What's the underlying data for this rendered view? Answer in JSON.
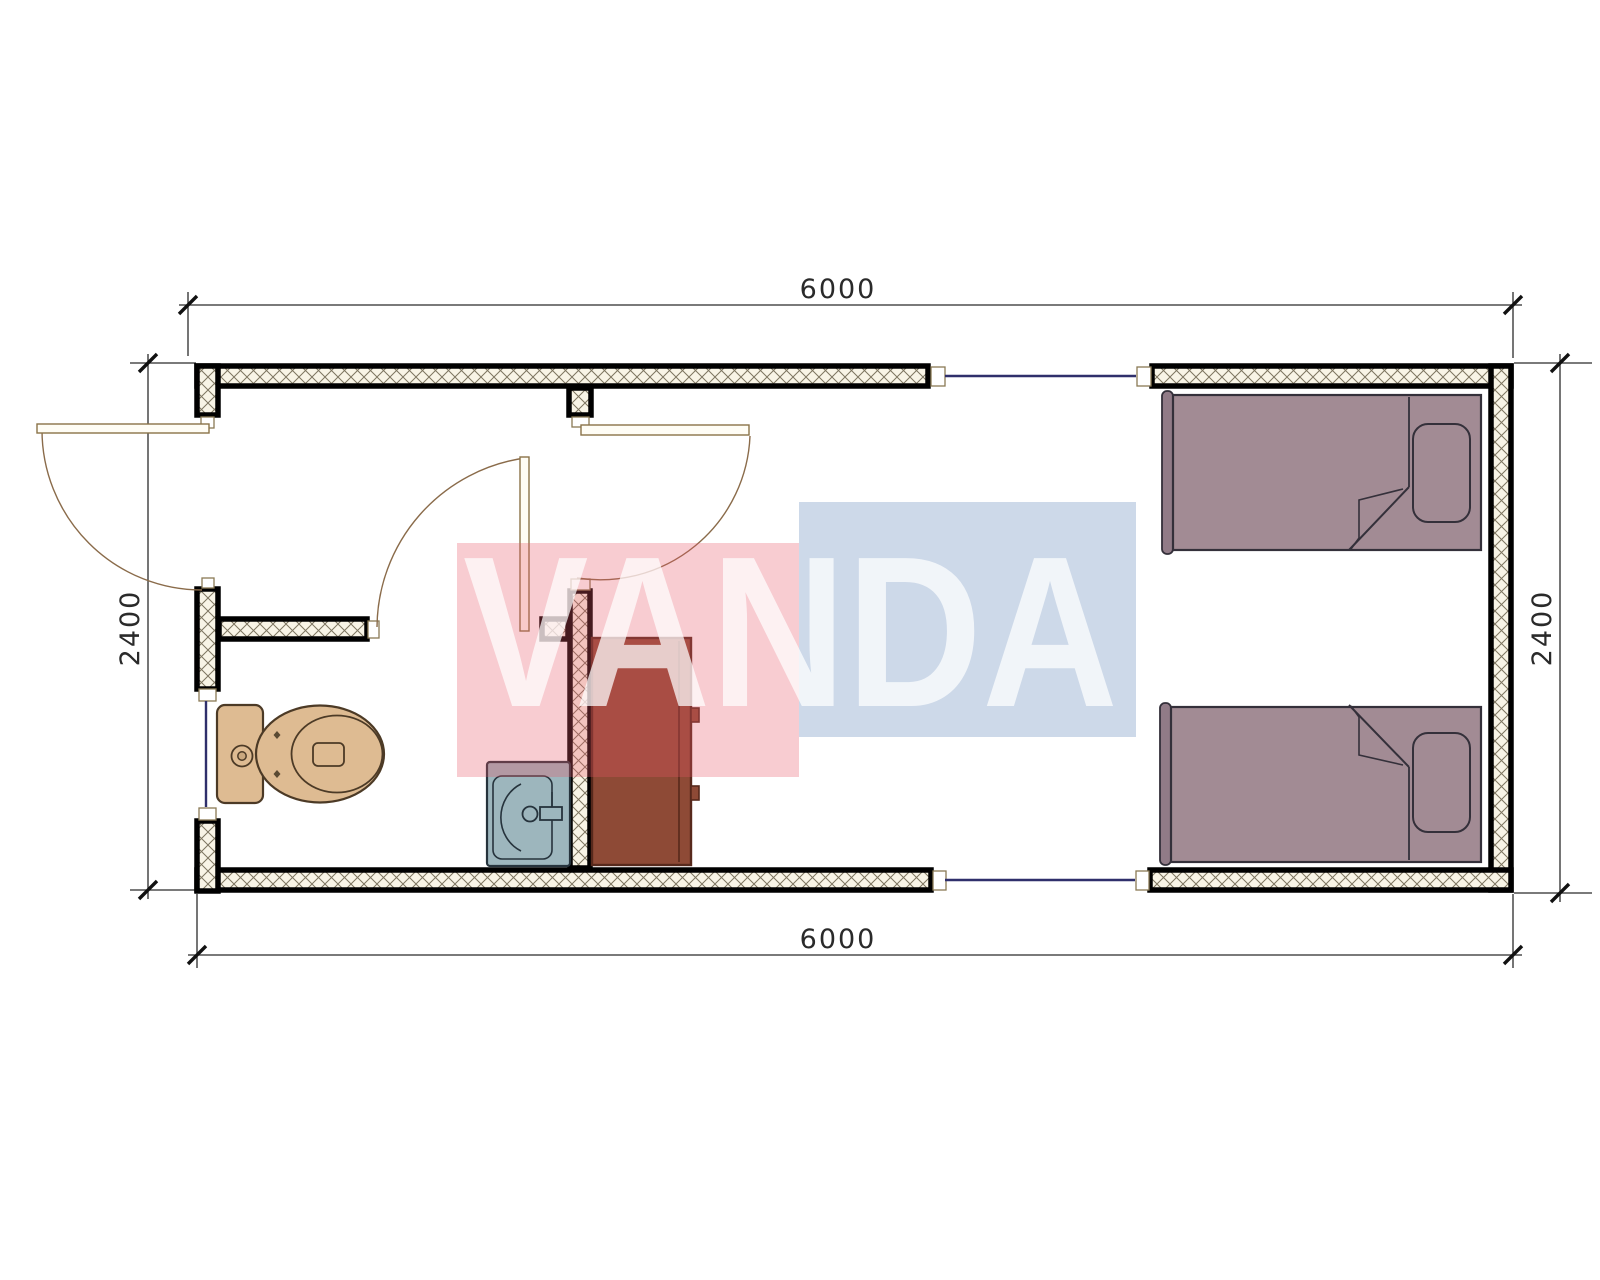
{
  "watermark": {
    "text": "VANDA",
    "red_block_color": "#f5cdd2",
    "blue_block_color": "#cdd9e9",
    "letter_color": "#ffffff"
  },
  "dimensions": {
    "top_width": "6000",
    "bottom_width": "6000",
    "left_height": "2400",
    "right_height": "2400"
  },
  "plan": {
    "type": "floor-plan",
    "fixtures": [
      "toilet",
      "wash-basin",
      "cabinet",
      "single-bed",
      "single-bed"
    ],
    "doors": [
      "entrance-door",
      "bathroom-door",
      "bedroom-door"
    ],
    "windows": [
      "left-wall-window",
      "top-wall-window",
      "bottom-wall-window"
    ]
  },
  "colors": {
    "wall_outline": "#000000",
    "wall_hatch_background": "#f8f4e6",
    "wall_hatch_line": "#7d7560",
    "window_line": "#2f2f6b",
    "door_line": "#8a6b4a",
    "toilet_fill": "#debb92",
    "sink_fill": "#9db6bd",
    "cabinet_fill": "#8e4a36",
    "bed_fill": "#a28b94",
    "dimension_line": "#2b2b2b"
  }
}
